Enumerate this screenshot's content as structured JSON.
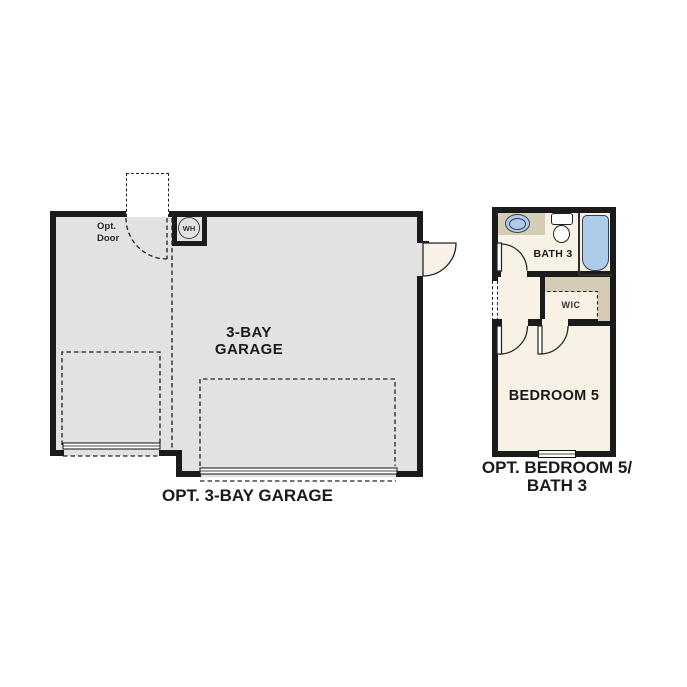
{
  "garage": {
    "room_label_line1": "3-BAY",
    "room_label_line2": "GARAGE",
    "caption": "OPT. 3-BAY GARAGE",
    "opt_door_label_line1": "Opt.",
    "opt_door_label_line2": "Door",
    "water_heater_label": "WH"
  },
  "bedroom_unit": {
    "bath_label": "BATH 3",
    "wic_label": "WIC",
    "bedroom_label": "BEDROOM 5",
    "caption_line1": "OPT. BEDROOM 5/",
    "caption_line2": "BATH 3"
  },
  "colors": {
    "wall": "#1b1b1b",
    "garage_floor": "#e3e2e0",
    "cream": "#f8f1e5",
    "tan": "#d5ccb6",
    "blue": "#aecbe9",
    "line": "#2b2b2b",
    "text": "#1a1a1a"
  }
}
